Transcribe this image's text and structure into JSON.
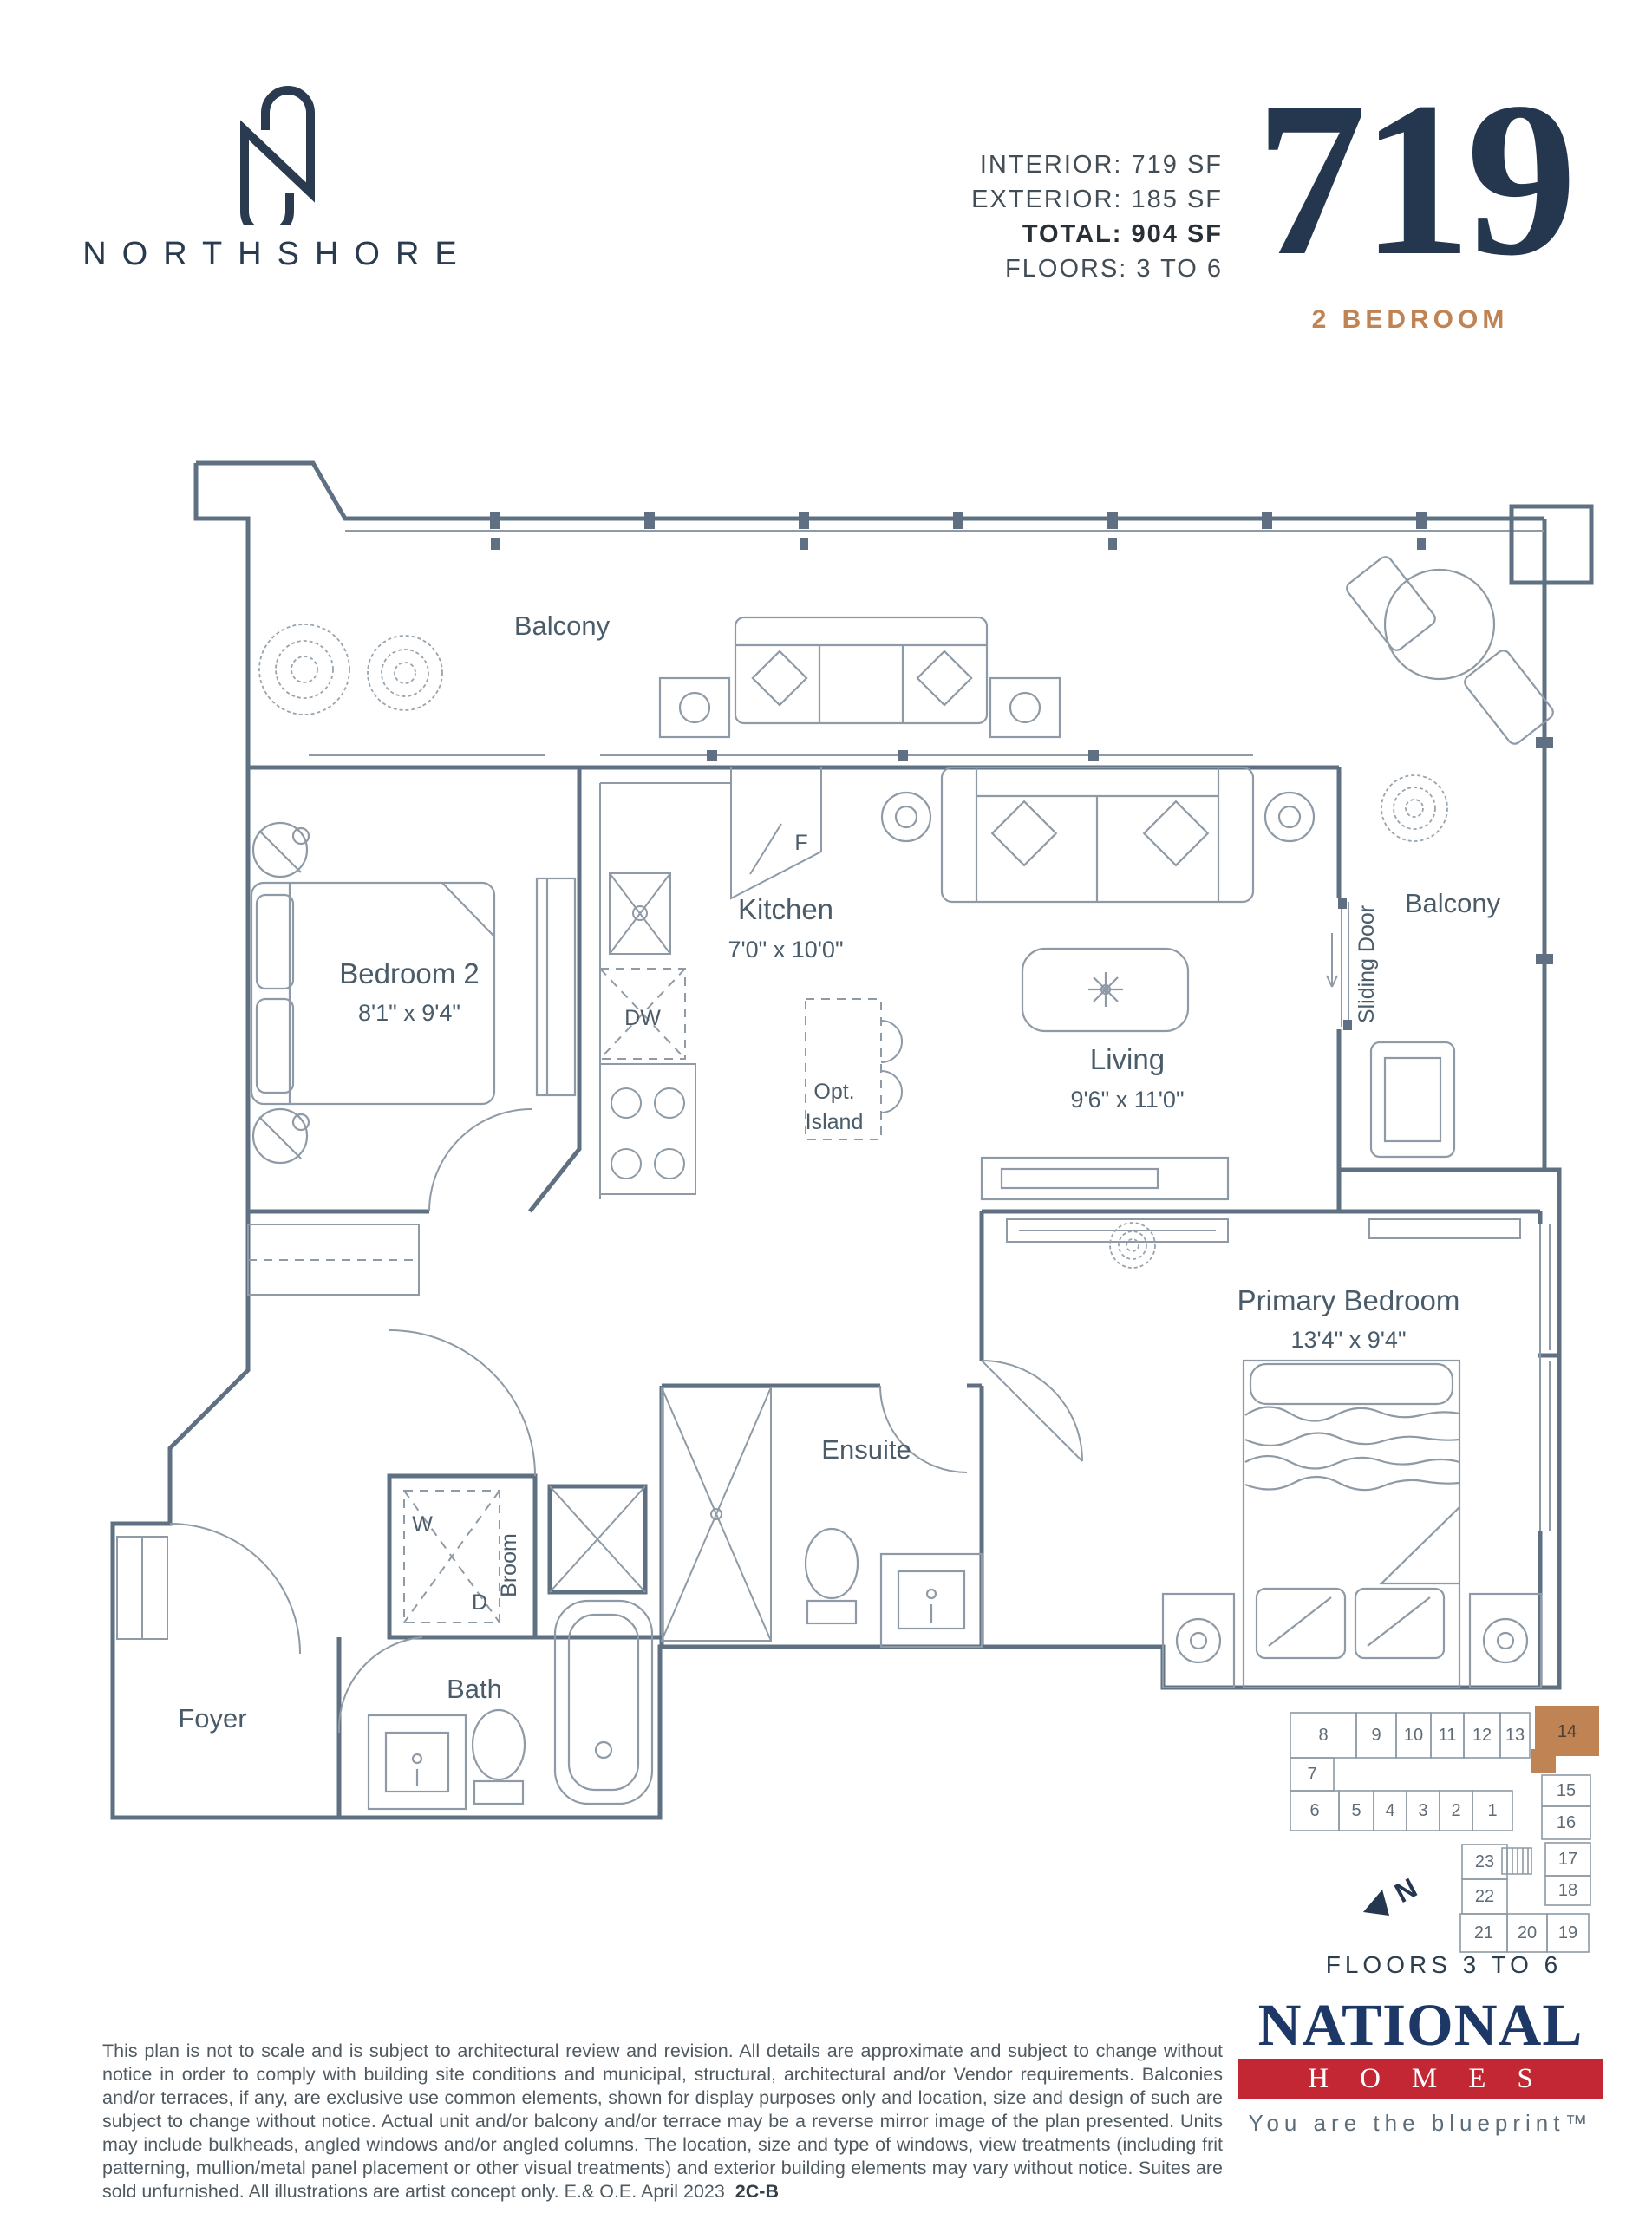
{
  "brand": {
    "name": "NORTHSHORE"
  },
  "header": {
    "stats": [
      {
        "text": "INTERIOR: 719 SF"
      },
      {
        "text": "EXTERIOR: 185 SF"
      },
      {
        "text": "TOTAL: 904 SF"
      },
      {
        "text": "FLOORS: 3 TO 6"
      }
    ],
    "unit_number": "719",
    "unit_type": "2 BEDROOM"
  },
  "floorplan": {
    "labels": {
      "balcony_top": "Balcony",
      "balcony_right": "Balcony",
      "sliding_door": "Sliding Door",
      "fridge": "F",
      "dishwasher": "DW",
      "washer": "W",
      "dryer": "D",
      "broom": "Broom",
      "island_line1": "Opt.",
      "island_line2": "Island"
    },
    "rooms": [
      {
        "name": "Bedroom 2",
        "dims": "8'1\" x 9'4\""
      },
      {
        "name": "Kitchen",
        "dims": "7'0\" x 10'0\""
      },
      {
        "name": "Living",
        "dims": "9'6\" x 11'0\""
      },
      {
        "name": "Primary Bedroom",
        "dims": "13'4\" x 9'4\""
      },
      {
        "name": "Ensuite"
      },
      {
        "name": "Bath"
      },
      {
        "name": "Foyer"
      }
    ]
  },
  "keyplan": {
    "units": [
      "8",
      "9",
      "10",
      "11",
      "12",
      "13",
      "14",
      "7",
      "6",
      "5",
      "4",
      "3",
      "2",
      "1",
      "15",
      "16",
      "17",
      "18",
      "23",
      "22",
      "21",
      "20",
      "19"
    ],
    "highlighted_unit": "14",
    "north_label": "N",
    "caption": "FLOORS  3 TO 6"
  },
  "disclaimer": {
    "text": "This plan is not to scale and is subject to architectural review and revision. All details are approximate and subject to change without notice in order to comply with building site conditions and municipal, structural, architectural and/or Vendor requirements. Balconies and/or terraces, if any, are exclusive use common elements, shown for display purposes only and location, size and design of such are subject to change without notice. Actual unit and/or balcony and/or terrace may be a reverse mirror image of the plan presented. Units may include bulkheads, angled windows and/or angled columns. The location, size and type of windows, view treatments (including frit patterning, mullion/metal panel placement or other visual treatments) and exterior building elements may vary without notice. Suites are sold unfurnished. All illustrations are artist concept only. E.& O.E. April 2023",
    "suffix": "2C-B"
  },
  "footer": {
    "brand_line1": "NATIONAL",
    "brand_line2": "HOMES",
    "tagline": "You are the blueprint™"
  },
  "colors": {
    "navy": "#24374e",
    "copper": "#bf8354",
    "plan_line": "#5e7081",
    "logo_navy": "#1d3766",
    "logo_red": "#c22733"
  }
}
